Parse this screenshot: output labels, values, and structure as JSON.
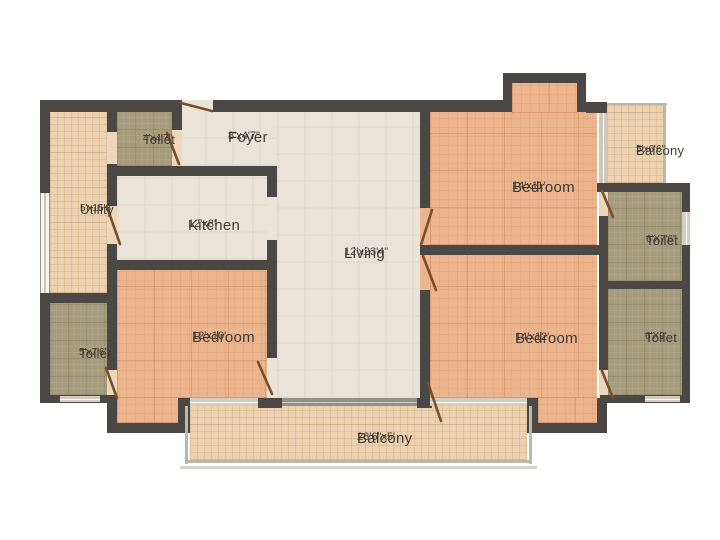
{
  "plan": {
    "rooms": [
      {
        "id": "utility",
        "name": "Utility",
        "dims": "5'x15'3\""
      },
      {
        "id": "toilet-top-left",
        "name": "Toilet",
        "dims": "4'x4'7\""
      },
      {
        "id": "foyer",
        "name": "Foyer",
        "dims": "8'x4'7\""
      },
      {
        "id": "kitchen",
        "name": "Kitchen",
        "dims": "12'x8'"
      },
      {
        "id": "living",
        "name": "Living",
        "dims": "12'x23'4\""
      },
      {
        "id": "bedroom-top-right",
        "name": "Bedroom",
        "dims": "14'x11'"
      },
      {
        "id": "balcony-top-right",
        "name": "Balcony",
        "dims": "5'x6'6\""
      },
      {
        "id": "toilet-right-upper",
        "name": "Toilet",
        "dims": "6'X7'6\""
      },
      {
        "id": "toilet-right-lower",
        "name": "Toilet",
        "dims": "6'X9'"
      },
      {
        "id": "bedroom-bottom-left",
        "name": "Bedroom",
        "dims": "12'x10'"
      },
      {
        "id": "toilet-bottom-left",
        "name": "Toilet",
        "dims": "5'x7'6\""
      },
      {
        "id": "bedroom-bottom-right",
        "name": "Bedroom",
        "dims": "14'x12'"
      },
      {
        "id": "balcony-bottom",
        "name": "Balcony",
        "dims": "28'6\"x5'"
      }
    ],
    "colors": {
      "background": "#ffffff",
      "wall": "#4a4744",
      "floor_cream": "#eae4d8",
      "floor_bedroom_peach": "#ecb58d",
      "floor_balcony_tan": "#ecd2b1",
      "floor_toilet_olive": "#a69b7c",
      "door_leaf_brown": "#7a4e2a"
    }
  }
}
